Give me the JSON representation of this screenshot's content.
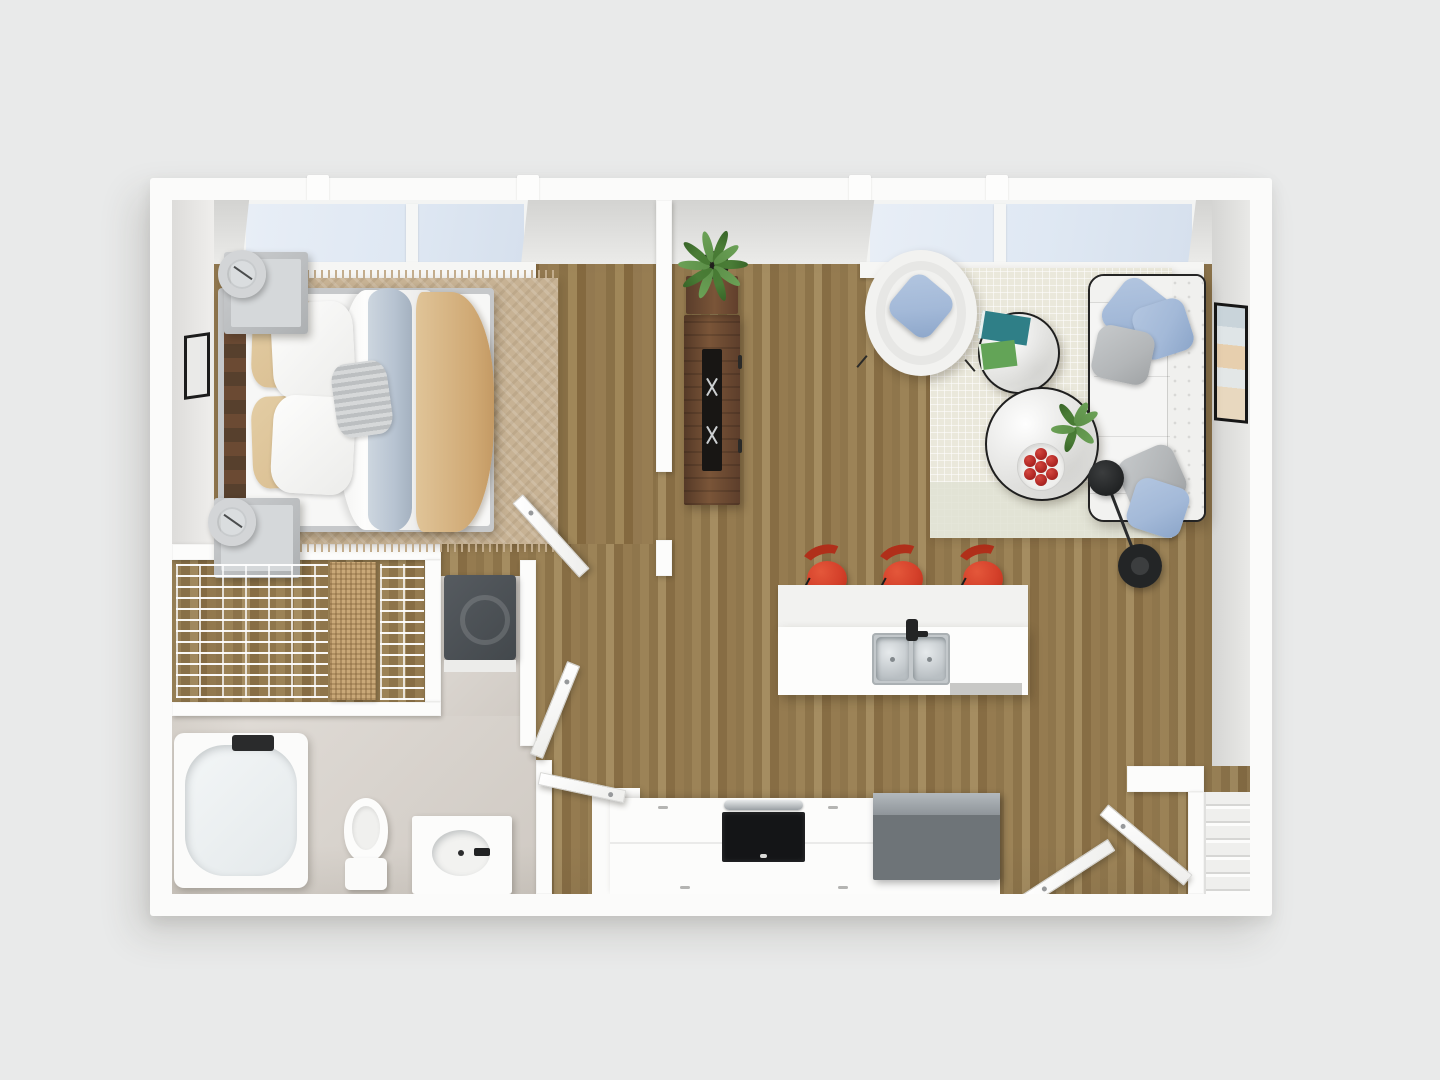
{
  "scene": {
    "kind": "3D rendered floor plan",
    "view": "top-down",
    "apartment_type": "One-bedroom apartment floor plan",
    "visible_text": "none"
  },
  "palette": {
    "bg": "#e9eaea",
    "wall": "#fbfbfa",
    "wall_face": "#d9d9d7",
    "wood": "#967c52",
    "bath_floor": "#d8d2cb",
    "glass": "#dfe8f3",
    "rug_bedroom": "#c7b294",
    "rug_living": "#eae8db",
    "sofa": "#f5f5f4",
    "piping": "#242424",
    "pillow_blue": "#a3b9d8",
    "pillow_gray": "#b3b6b8",
    "stool_red": "#d4402a",
    "stool_red_dark": "#b02f1a",
    "walnut": "#6b4a33",
    "appliance_gray": "#6e7478",
    "steel": "#cfd3d6",
    "plant_green": "#4a7c36",
    "lamp_black": "#2a2c2d",
    "berry_red": "#b02724",
    "tan_bedding": "#d9bd90",
    "throw_blue": "#b7c3d1"
  },
  "rooms": {
    "bedroom": {
      "name": "Bedroom",
      "floor": "hardwood"
    },
    "closet": {
      "name": "Walk-in closet",
      "floor": "hardwood"
    },
    "laundry": {
      "name": "Laundry nook",
      "floor": "tile"
    },
    "bathroom": {
      "name": "Bathroom",
      "floor": "tile"
    },
    "living": {
      "name": "Living room",
      "floor": "hardwood"
    },
    "kitchen": {
      "name": "Kitchen",
      "floor": "hardwood"
    },
    "entry": {
      "name": "Entry",
      "floor": "hardwood"
    }
  },
  "furniture": {
    "bed": "Queen bed with tan and white bedding",
    "nightstand": "Nightstand with lamp",
    "bedroom_rug": "Tan area rug with fringe",
    "bedroom_art": "Wall art",
    "wire_shelving": "Wire closet shelving",
    "basket": "Woven storage baskets",
    "washer": "Washer / dryer",
    "bathtub": "Bathtub",
    "toilet": "Toilet",
    "vanity": "Vanity sink",
    "window": "Window",
    "door": "Interior door",
    "entry_door": "Entry door",
    "island": "Kitchen island with double sink",
    "sink": "Double stainless sink",
    "dishwasher": "Dishwasher",
    "stool": "Red bar stool",
    "counter": "Kitchen counter",
    "cooktop": "Range with oven",
    "fridge": "Refrigerator",
    "sofa": "White tufted sofa",
    "armchair": "Round armchair",
    "side_table": "Round side table with books",
    "coffee_table": "Round coffee table",
    "fruit_bowl": "Bowl of red fruit",
    "floor_lamp": "Black arc floor lamp",
    "living_rug": "Cream living room rug",
    "console": "Walnut media console",
    "tv": "Television",
    "plant": "Potted plant",
    "framed_art": "Framed abstract art",
    "coat_closet": "Entry coat closet shelving"
  }
}
